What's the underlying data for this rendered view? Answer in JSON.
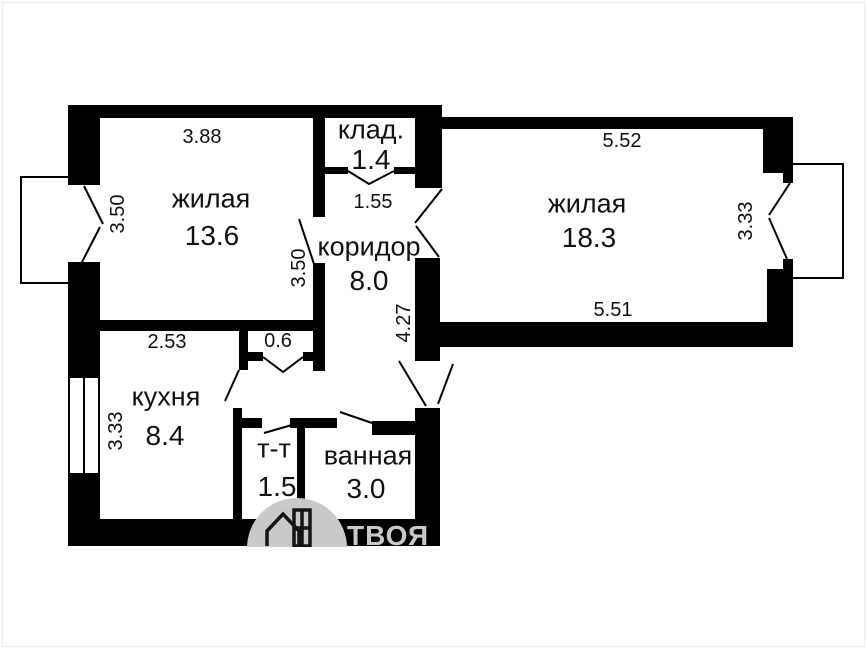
{
  "plan": {
    "rooms": [
      {
        "name": "жилая",
        "area": "13.6"
      },
      {
        "name": "клад.",
        "area": "1.4"
      },
      {
        "name": "коридор",
        "area": "8.0"
      },
      {
        "name": "жилая",
        "area": "18.3"
      },
      {
        "name": "кухня",
        "area": "8.4"
      },
      {
        "name": "т-т",
        "area": "1.5"
      },
      {
        "name": "ванная",
        "area": "3.0"
      }
    ],
    "dimensions": {
      "living1_width": "3.88",
      "living1_depth": "3.50",
      "closet_width": "1.55",
      "corridor_upper": "3.50",
      "corridor_lower": "4.27",
      "living2_top": "5.52",
      "living2_bottom": "5.51",
      "living2_depth": "3.33",
      "kitchen_top": "2.53",
      "kitchen_depth": "3.33",
      "niche": "0.6"
    },
    "colors": {
      "wall": "#000000",
      "background": "#ffffff",
      "watermark": "#c9c9c9"
    }
  },
  "watermark": {
    "brand": "ТВОЯ"
  }
}
